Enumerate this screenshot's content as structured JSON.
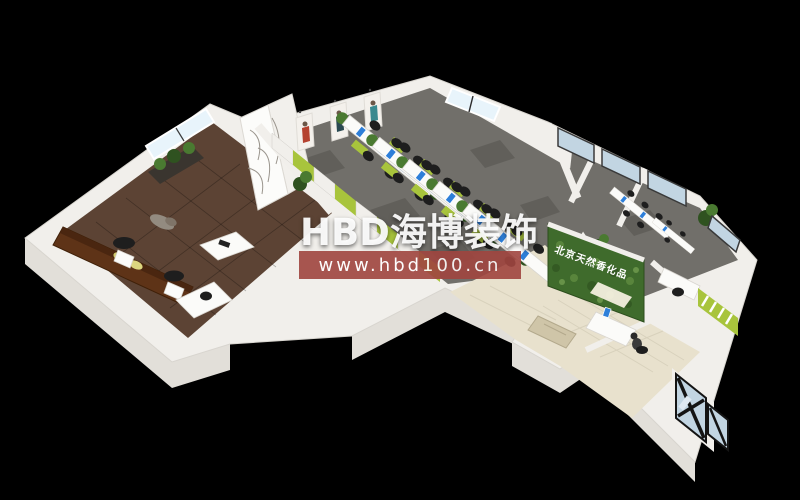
{
  "watermark": {
    "brand": "HBD海博装饰",
    "url": "www.hbd100.cn"
  },
  "plant_wall": {
    "sign": "北京天然香化品"
  },
  "scene": {
    "colors": {
      "bg": "#000000",
      "wall": "#f1efeb",
      "wall-shade": "#e2dfd9",
      "wood": "#5c4334",
      "carpet": "#716f6a",
      "tile": "#e8e1cd",
      "tile-line": "#d8d1bc",
      "accent-green": "#a8c43c",
      "plant": "#4a7a31",
      "plant-dark": "#2f5220",
      "glass": "#e8f4fb",
      "glass-dark": "#c2d5e2",
      "desk-white": "#fbfbf9",
      "monitor-blue": "#2e7fd9",
      "chair-black": "#1e1e1e",
      "sofa-brown": "#5e3317",
      "banner-red": "#a0453f"
    }
  }
}
